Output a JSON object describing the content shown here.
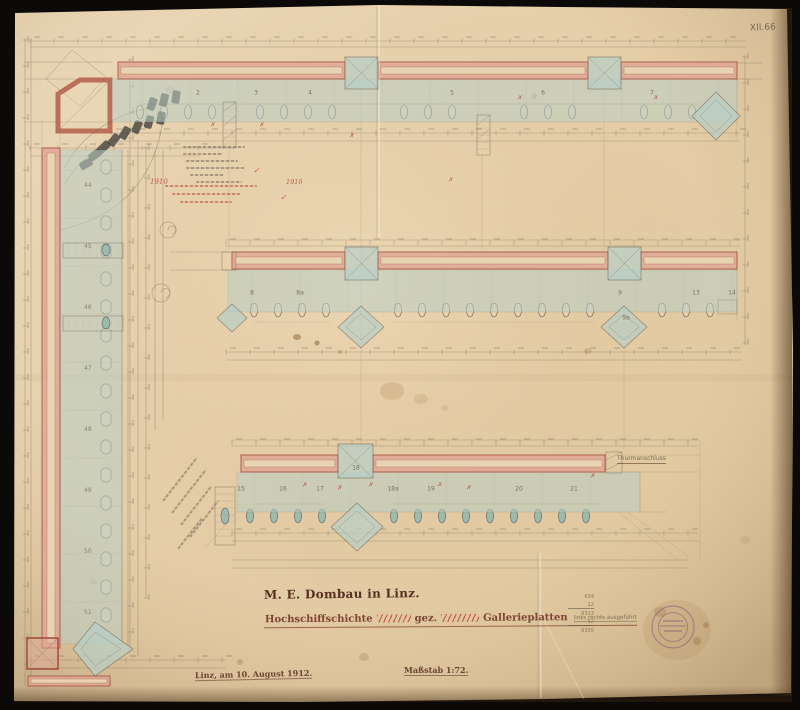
{
  "sheet": {
    "plan_number": "XII.66",
    "title": "M. E. Dombau in Linz.",
    "subtitle": {
      "part1": "Hochschiffschichte",
      "part2": "gez.",
      "part3": "Gallerieplatten",
      "note": "links rechts ausgeführt"
    },
    "date_line": "Linz, am 10. August 1912.",
    "scale_line": "Maßstab 1:72.",
    "colors": {
      "paper": "#e6d1ae",
      "wall_red": "#c96a56",
      "wash_blue": "#b9cfc7",
      "pencil": "#6f6454",
      "ink_red": "#b5473a",
      "ink_brown": "#553021"
    }
  },
  "annotations": {
    "red_year_left": "1910",
    "red_year_right": "1916",
    "check_mark": "✓",
    "tower_note": "Thurmanschluss",
    "pencil_sum": [
      "634",
      "12",
      "6313",
      "52",
      "6355"
    ],
    "left_plate_numbers": [
      "44",
      "45",
      "46",
      "47",
      "48",
      "49",
      "50",
      "51"
    ],
    "panel_numbers_top": [
      {
        "t": "2",
        "x": 198
      },
      {
        "t": "3",
        "x": 256
      },
      {
        "t": "4",
        "x": 310
      },
      {
        "t": "5",
        "x": 452
      },
      {
        "t": "6",
        "x": 543
      },
      {
        "t": "7",
        "x": 652
      }
    ],
    "panel_numbers_middle": [
      {
        "t": "8",
        "x": 252
      },
      {
        "t": "8a",
        "x": 300
      },
      {
        "t": "9",
        "x": 620
      },
      {
        "t": "9a",
        "x": 626,
        "y": 318
      },
      {
        "t": "13",
        "x": 696
      },
      {
        "t": "14",
        "x": 732
      }
    ],
    "panel_numbers_lower": [
      {
        "t": "15",
        "x": 241
      },
      {
        "t": "16",
        "x": 283
      },
      {
        "t": "17",
        "x": 320
      },
      {
        "t": "18",
        "x": 356,
        "y": 468
      },
      {
        "t": "18a",
        "x": 393
      },
      {
        "t": "19",
        "x": 431
      },
      {
        "t": "20",
        "x": 519
      },
      {
        "t": "21",
        "x": 574
      }
    ],
    "red_marks": [
      {
        "x": 305,
        "y": 485
      },
      {
        "x": 340,
        "y": 488
      },
      {
        "x": 371,
        "y": 485
      },
      {
        "x": 440,
        "y": 485
      },
      {
        "x": 469,
        "y": 488
      },
      {
        "x": 593,
        "y": 476
      },
      {
        "x": 451,
        "y": 180
      },
      {
        "x": 520,
        "y": 98
      },
      {
        "x": 656,
        "y": 98
      },
      {
        "x": 213,
        "y": 125
      },
      {
        "x": 262,
        "y": 125
      },
      {
        "x": 352,
        "y": 136
      }
    ]
  }
}
